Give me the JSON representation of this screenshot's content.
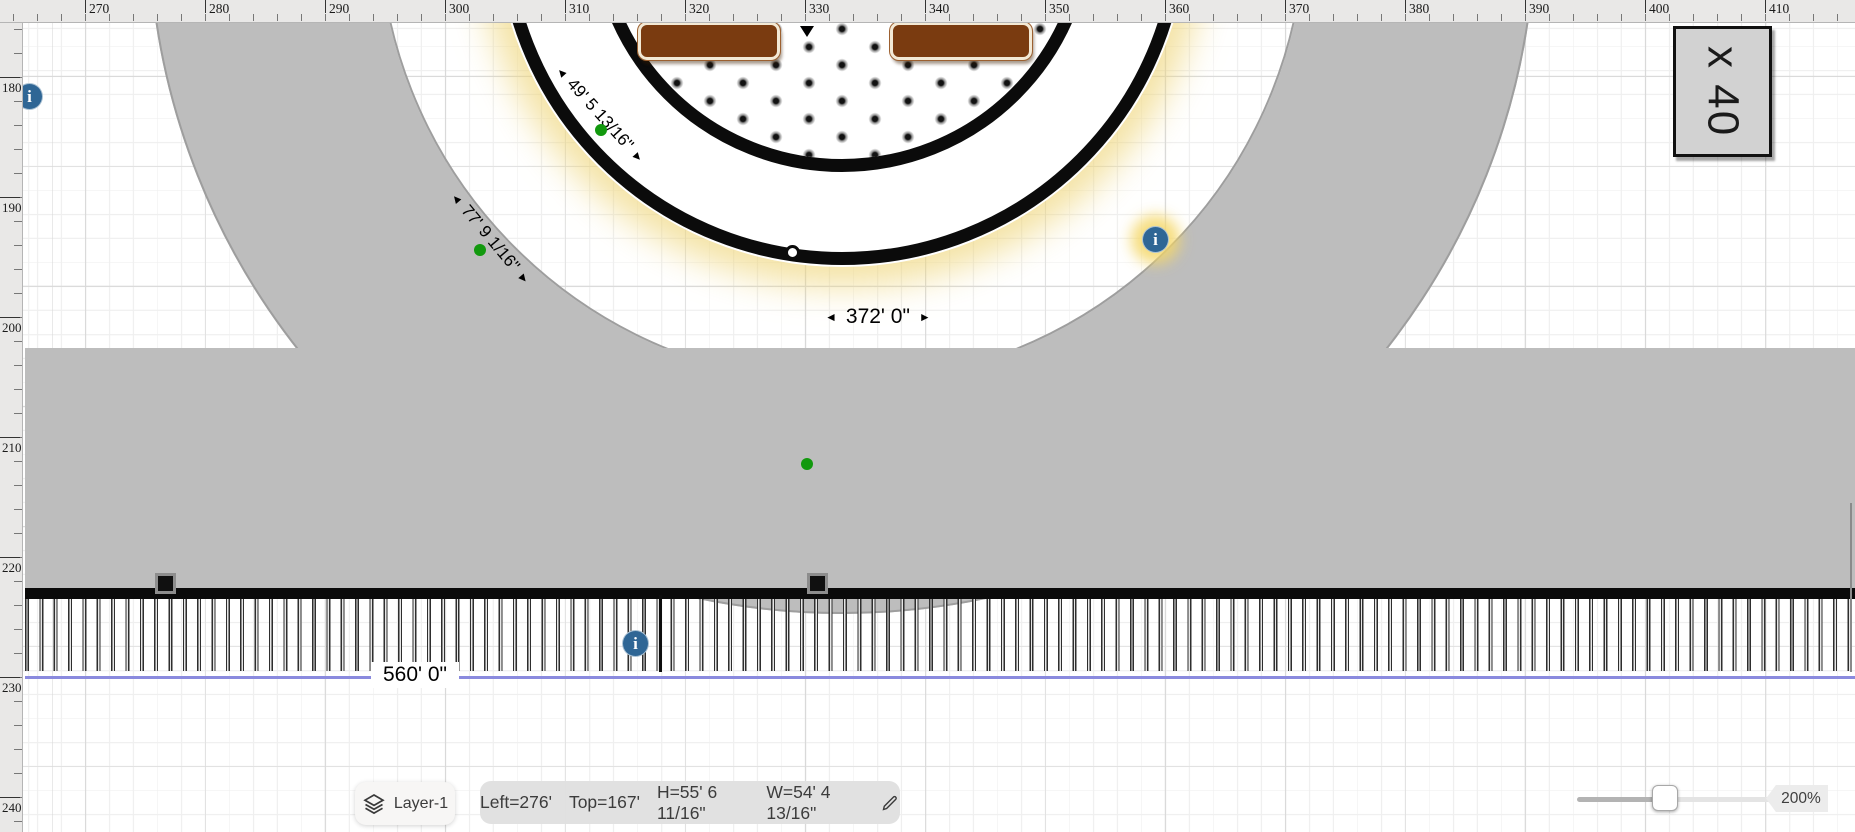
{
  "rulers": {
    "top": {
      "labels": [
        270,
        280,
        290,
        300,
        310,
        320,
        330,
        340,
        350,
        360,
        370,
        380,
        390,
        400,
        410
      ],
      "origin_px": 85,
      "major_step_px": 120,
      "minor_step_px": 24,
      "minor_start_px": 13,
      "length_px": 1855
    },
    "left": {
      "labels": [
        180,
        190,
        200,
        210,
        220,
        230,
        240
      ],
      "origin_px": 77,
      "major_step_px": 120,
      "minor_step_px": 24,
      "minor_start_px": 5,
      "length_px": 832
    }
  },
  "annotations": {
    "dim_arc_small": {
      "text": "49' 5 13/16\""
    },
    "dim_arc_large": {
      "text": "77' 9 1/16\""
    },
    "dim_width_circle": {
      "text": "372' 0\""
    },
    "dim_width_bottom": {
      "text": "560' 0\""
    },
    "multiplier_box": {
      "text": "x 40"
    }
  },
  "icons": {
    "left_arrow": "◄",
    "right_arrow": "►",
    "info": "i"
  },
  "statusbar": {
    "layer_button": {
      "label": "Layer-1"
    },
    "selection": {
      "left": "Left=276'",
      "top": "Top=167'",
      "height": "H=55' 6 11/16\"",
      "width": "W=54' 4 13/16\""
    },
    "zoom": {
      "value": "200%"
    }
  },
  "colors": {
    "stands_gray": "#bdbdbd",
    "wall_black": "#0a0a0a",
    "glow_yellow": "#eed474",
    "table_brown": "#7a3b10",
    "table_border_cream": "#f3e9d5",
    "vertex_green": "#12990e",
    "info_blue": "#2f6695",
    "dimension_line_blue": "#8a8ade",
    "ruler_bg": "#e9e8e7",
    "pill_bg": "#e0e0e0"
  }
}
